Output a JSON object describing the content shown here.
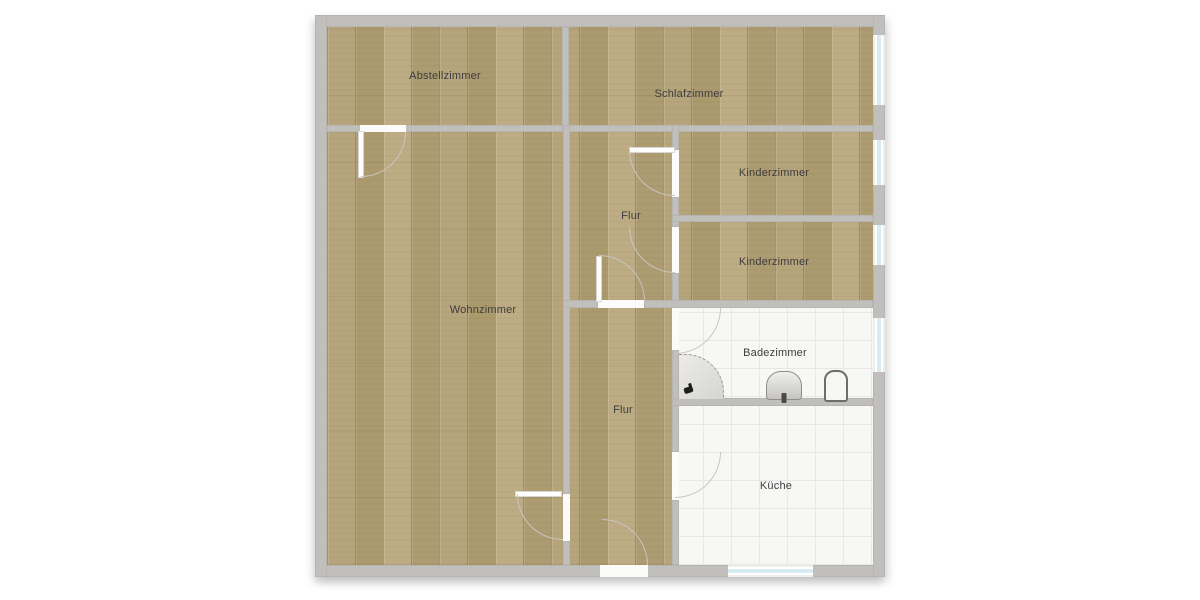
{
  "floorplan": {
    "rooms": [
      {
        "name": "Abstellzimmer",
        "floor": "wood"
      },
      {
        "name": "Schlafzimmer",
        "floor": "wood",
        "windows": 1
      },
      {
        "name": "Kinderzimmer",
        "floor": "wood",
        "windows": 1
      },
      {
        "name": "Flur",
        "floor": "wood"
      },
      {
        "name": "Kinderzimmer",
        "floor": "wood",
        "windows": 1
      },
      {
        "name": "Wohnzimmer",
        "floor": "wood"
      },
      {
        "name": "Badezimmer",
        "floor": "tile",
        "windows": 1,
        "fixtures": [
          "corner-shower",
          "sink",
          "toilet"
        ]
      },
      {
        "name": "Flur",
        "floor": "wood"
      },
      {
        "name": "Küche",
        "floor": "tile",
        "windows": 1
      }
    ],
    "colors": {
      "wall": "#c1bfbb",
      "wood_floor": "#b1a076",
      "tile_floor": "#f7f7f5",
      "window_glass": "#d7ebf2",
      "label_text": "#3d3d3d"
    }
  }
}
